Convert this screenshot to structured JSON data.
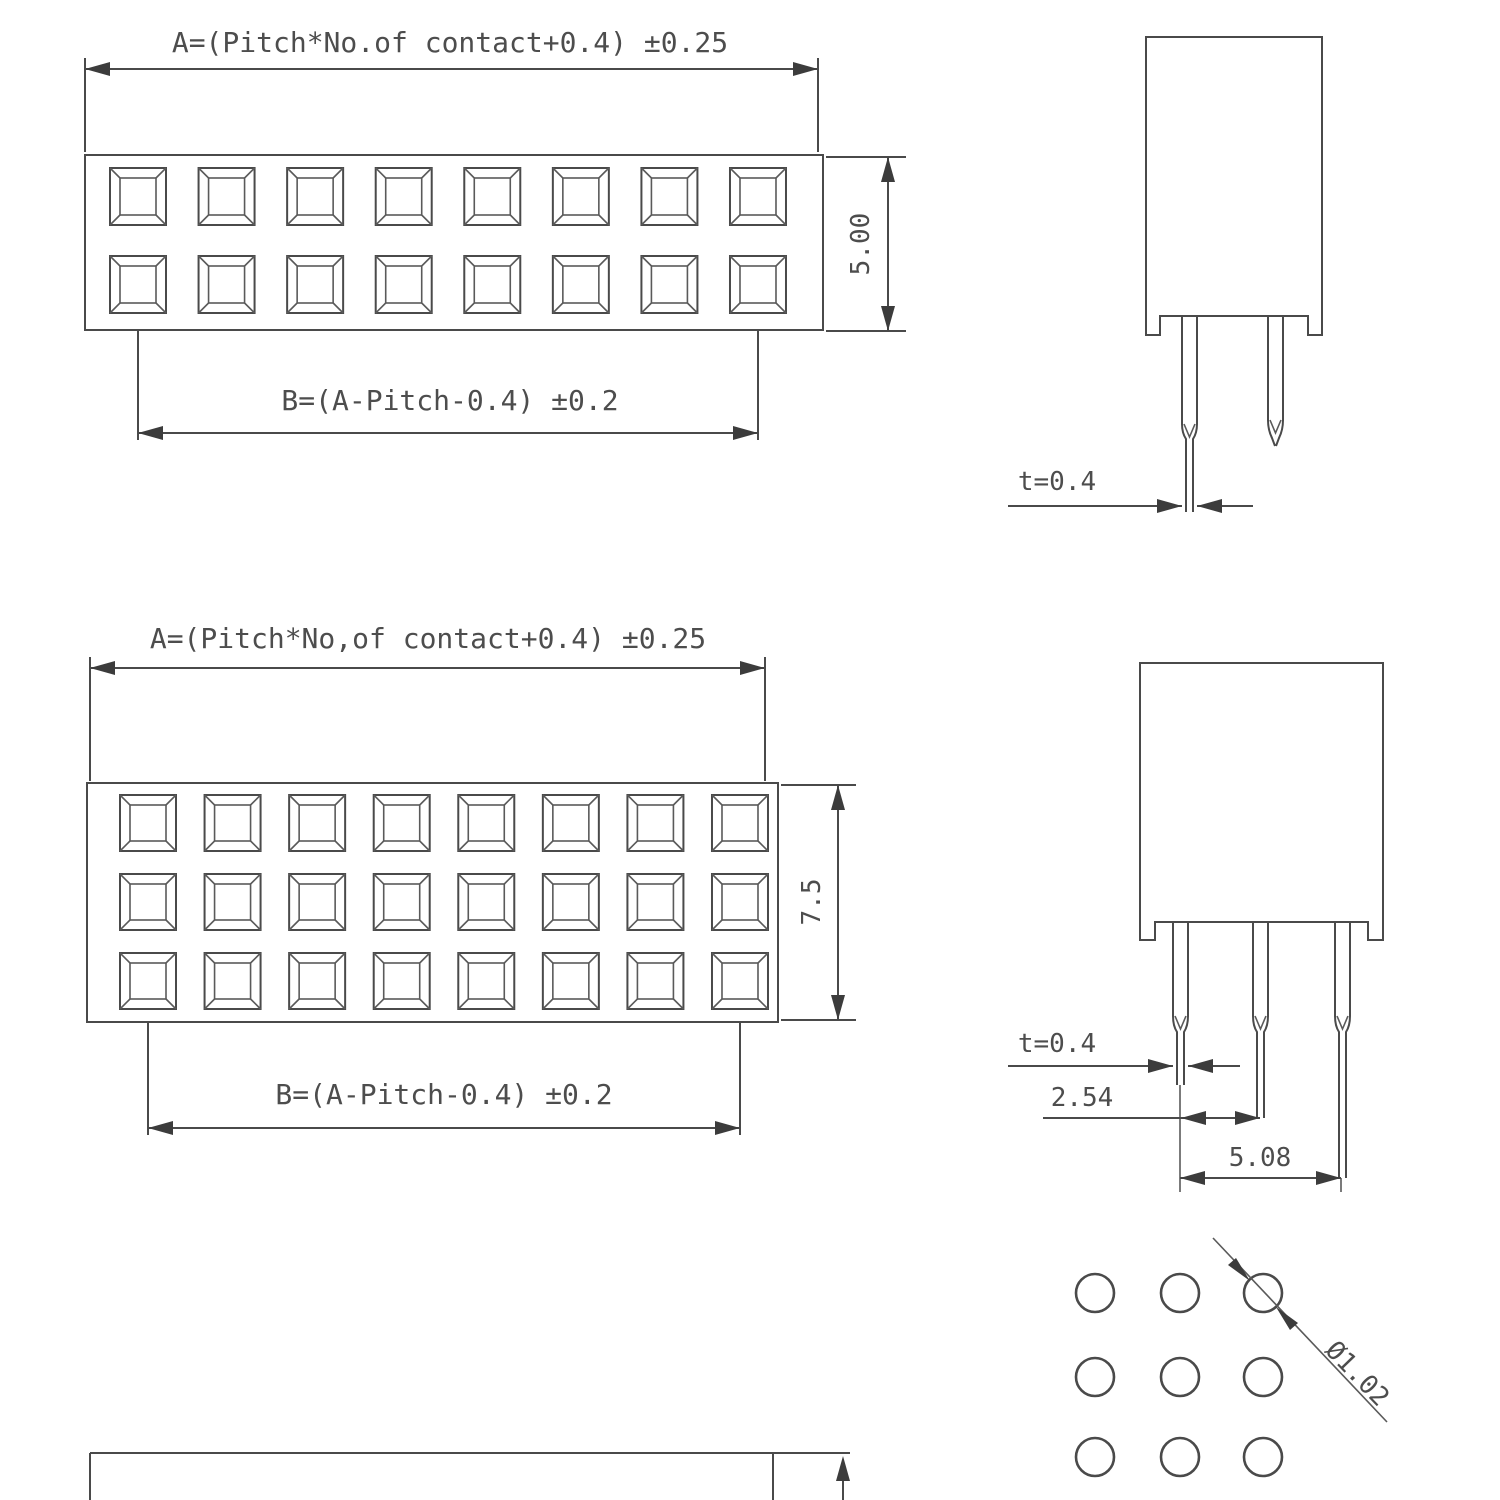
{
  "drawing": {
    "title_hint": "female pin header connector dimension drawing",
    "annotations": {
      "dim_a_top": "A=(Pitch*No.of contact+0.4) ±0.25",
      "dim_b_top": "B=(A-Pitch-0.4) ±0.2",
      "height_top": "5.00",
      "thickness_top": "t=0.4",
      "dim_a_mid": "A=(Pitch*No,of contact+0.4) ±0.25",
      "dim_b_mid": "B=(A-Pitch-0.4) ±0.2",
      "height_mid": "7.5",
      "thickness_mid": "t=0.4",
      "pitch_dim": "2.54",
      "dual_pitch_dim": "5.08",
      "hole_diameter": "Ø1.02"
    },
    "views": {
      "front_2row": {
        "rows": 2,
        "contacts_per_row": 8
      },
      "front_3row": {
        "rows": 3,
        "contacts_per_row": 8
      },
      "side_2pin": {
        "pins": 2
      },
      "side_3pin": {
        "pins": 3
      },
      "hole_pattern": {
        "rows": 3,
        "cols": 3
      }
    },
    "colors": {
      "line": "#4a4a4a",
      "text": "#4d4d4d",
      "background": "#ffffff"
    }
  }
}
